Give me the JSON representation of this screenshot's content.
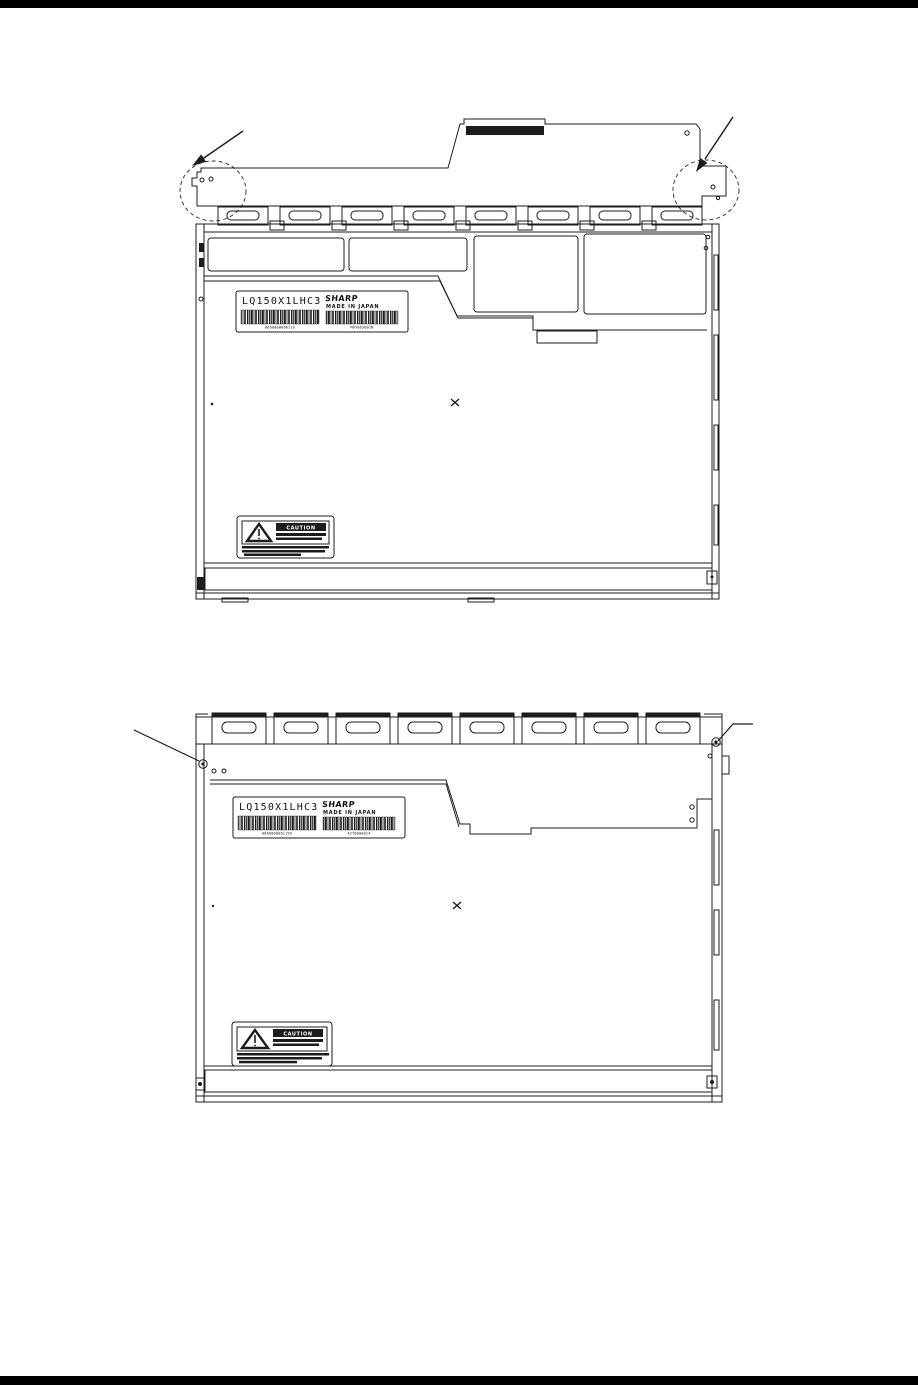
{
  "colors": {
    "ink": "#1c1c1c",
    "paper": "#ffffff",
    "rule": "#000000"
  },
  "diagram_top": {
    "label": {
      "model": "LQ150X1LHC3",
      "brand": "SHARP",
      "origin": "MADE IN JAPAN",
      "serial_left": "0660000606110",
      "serial_right": "M6Y863001N"
    },
    "caution": {
      "title": "CAUTION"
    }
  },
  "diagram_bottom": {
    "label": {
      "model": "LQ150X1LHC3",
      "brand": "SHARP",
      "origin": "MADE IN JAPAN",
      "serial_left": "0660000061199",
      "serial_right": "42T0000014"
    },
    "caution": {
      "title": "CAUTION"
    }
  }
}
